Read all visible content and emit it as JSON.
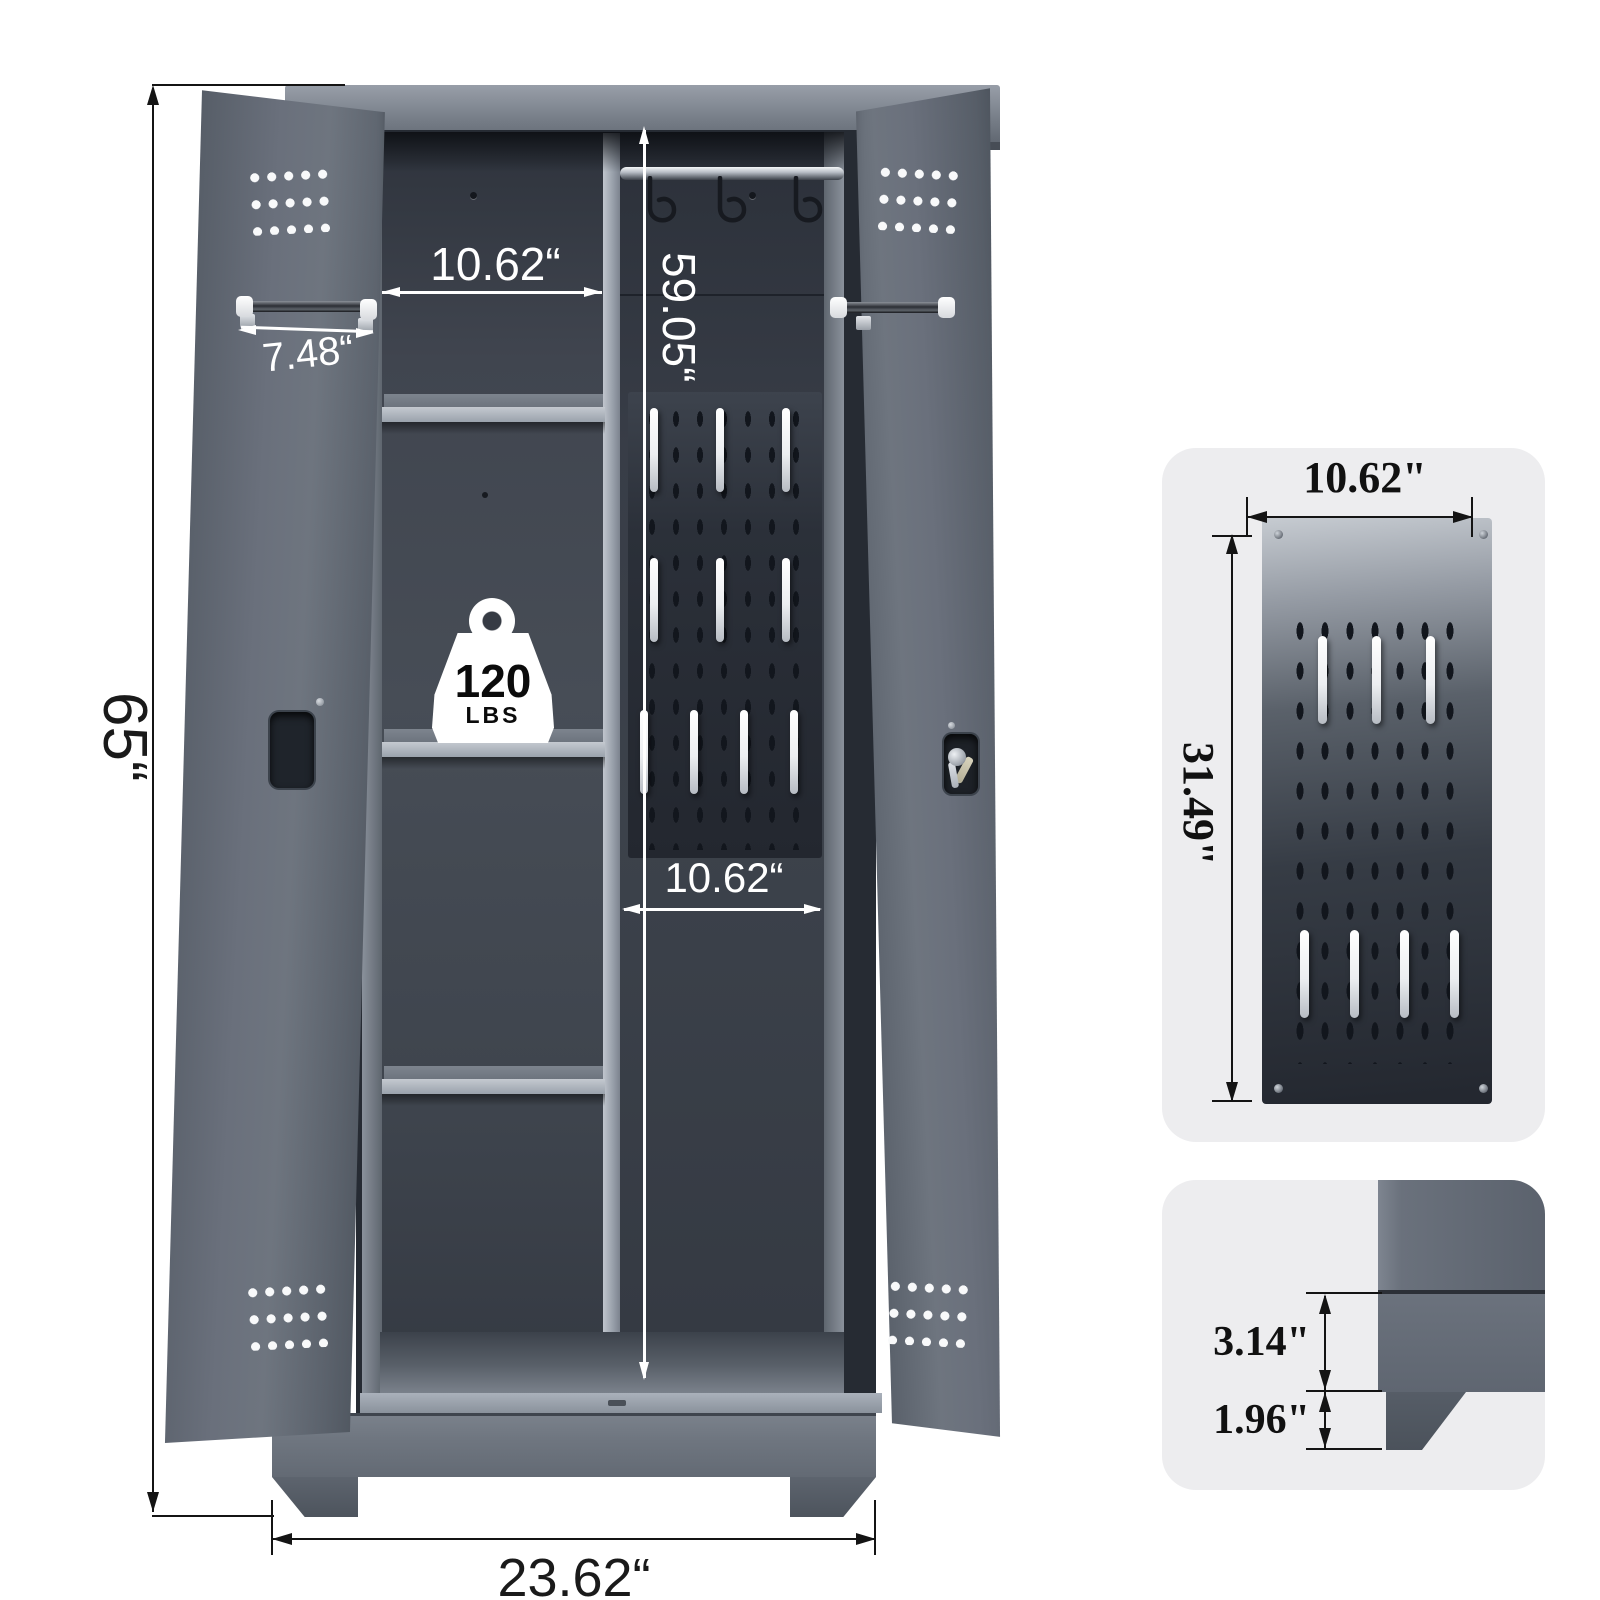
{
  "image_type": "storage cabinet dimension diagram",
  "labels": {
    "overall_height": "65“",
    "overall_width": "23.62“",
    "handle_bar_width": "7.48“",
    "left_compartment_width": "10.62“",
    "hanging_compartment_height": "59.05“",
    "hanging_compartment_width": "10.62“"
  },
  "weight_badge": {
    "value": "120",
    "unit": "LBS"
  },
  "inset_pegboard": {
    "width": "10.62\"",
    "height": "31.49\""
  },
  "inset_base": {
    "plinth_height": "3.14\"",
    "leg_height": "1.96\""
  },
  "colors": {
    "cabinet_gray": "#5d646f",
    "interior_dark": "#343942",
    "shelf_light": "#a9b1bb",
    "pegboard_dark": "#262b34",
    "dimension_white": "#ffffff",
    "dimension_black": "#141414",
    "inset_background": "#ededef"
  }
}
